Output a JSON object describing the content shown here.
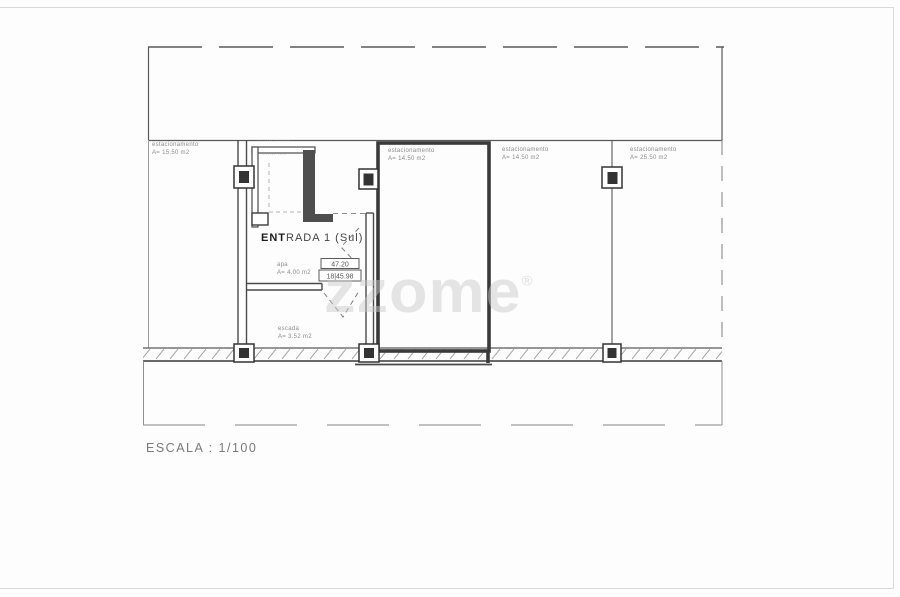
{
  "page": {
    "watermark": "zzome",
    "watermark_reg": "®",
    "scale_label": "ESCALA : 1/100"
  },
  "plan": {
    "parking": [
      {
        "name": "estacionamento",
        "area": "A= 15.50 m2"
      },
      {
        "name": "estacionamento",
        "area": "A= 14.50 m2"
      },
      {
        "name": "estacionamento",
        "area": "A= 14.50 m2"
      },
      {
        "name": "estacionamento",
        "area": "A= 25.50 m2"
      }
    ],
    "entrance": {
      "bold": "ENT",
      "rest": "RADA 1 (Sul)"
    },
    "hall": {
      "name": "apa",
      "area": "A= 4.00 m2"
    },
    "stairs": {
      "name": "escada",
      "area": "A= 3.52 m2"
    },
    "levels": {
      "upper": "47.20",
      "lower": "18|45.98"
    },
    "tiny": {
      "row_above_room": "·· ···· ·······",
      "row_in_room": "······ ····"
    }
  }
}
